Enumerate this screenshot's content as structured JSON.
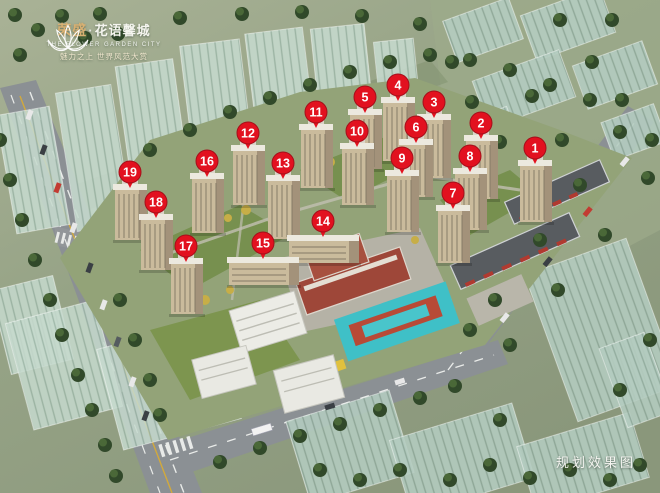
{
  "logo": {
    "brand": "荣盛",
    "separator": "·",
    "project": "花语馨城",
    "english_subtitle": "THE FLOWER GARDEN CITY",
    "tagline": "魅力之上 世界风范大赏"
  },
  "caption": "规划效果图",
  "colors": {
    "marker": "#e2111f",
    "marker_ring": "#a50f1a",
    "marker_text": "#ffffff",
    "tower_face": "#cabb9c",
    "tower_side": "#a3927a",
    "tower_roof": "#ece9df",
    "tower_window": "#857a67",
    "glass": "#c3d8cb",
    "ground": "#95a283",
    "tree": "#31492a",
    "road": "#8b9094",
    "school_brick": "#9e4739",
    "playground": "#3fc0c7",
    "track": "#b84a36"
  },
  "map": {
    "markers": [
      {
        "label": "1",
        "x": 535,
        "y": 148
      },
      {
        "label": "2",
        "x": 481,
        "y": 123
      },
      {
        "label": "3",
        "x": 434,
        "y": 102
      },
      {
        "label": "4",
        "x": 398,
        "y": 85
      },
      {
        "label": "5",
        "x": 365,
        "y": 97
      },
      {
        "label": "6",
        "x": 416,
        "y": 127
      },
      {
        "label": "7",
        "x": 453,
        "y": 193
      },
      {
        "label": "8",
        "x": 470,
        "y": 156
      },
      {
        "label": "9",
        "x": 402,
        "y": 158
      },
      {
        "label": "10",
        "x": 357,
        "y": 131
      },
      {
        "label": "11",
        "x": 316,
        "y": 112
      },
      {
        "label": "12",
        "x": 248,
        "y": 133
      },
      {
        "label": "13",
        "x": 283,
        "y": 163
      },
      {
        "label": "14",
        "x": 323,
        "y": 221
      },
      {
        "label": "15",
        "x": 263,
        "y": 243
      },
      {
        "label": "16",
        "x": 207,
        "y": 161
      },
      {
        "label": "17",
        "x": 186,
        "y": 246
      },
      {
        "label": "18",
        "x": 156,
        "y": 202
      },
      {
        "label": "19",
        "x": 130,
        "y": 172
      }
    ]
  }
}
